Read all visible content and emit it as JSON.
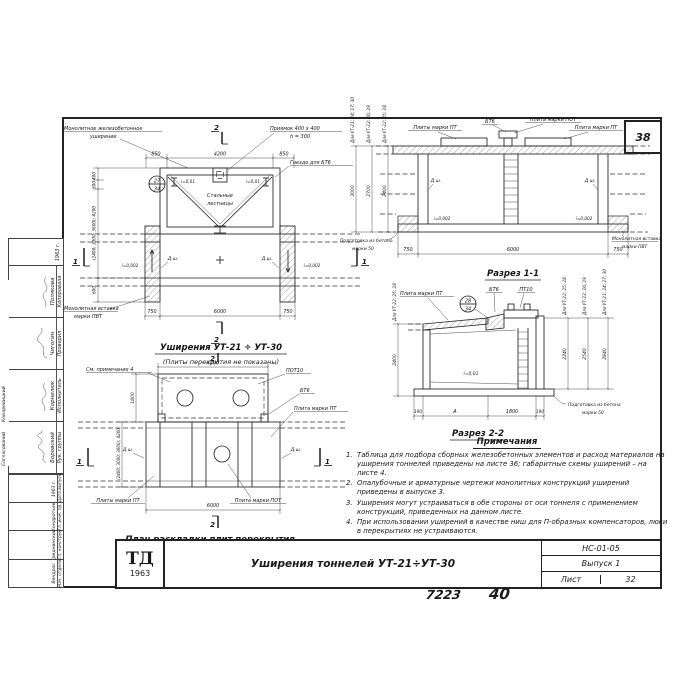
{
  "sheet": {
    "corner_number": "38",
    "footer_code": "7223",
    "footer_page": "40"
  },
  "titleblock": {
    "logo_top": "ТД",
    "logo_year": "1963",
    "title": "Уширения тоннелей УТ-21÷УТ-30",
    "doc_code": "НС-01-05",
    "issue": "Выпуск 1",
    "sheet_label": "Лист",
    "sheet_number": "32"
  },
  "stamp": {
    "side_role": "Согласований",
    "side_name": "Комаровицкий",
    "top_rows": [
      {
        "role": "Рук. группы",
        "name": "Боровский"
      },
      {
        "role": "Исполнитель",
        "name": "Корнилюк"
      },
      {
        "role": "Проверил",
        "name": "Чигогин"
      },
      {
        "role": "Копировала",
        "name": "Полякова"
      }
    ],
    "top_year": "1963 г.",
    "bottom_rows": [
      {
        "role": "Нач. отдела",
        "name": "Вендрос"
      },
      {
        "role": "Гл. конструктор",
        "name": "Гриднинский"
      },
      {
        "role": "Гл. инж. пр.",
        "name": "Кондратьев"
      },
      {
        "role": "Дата выпуска",
        "name": "1963 г."
      }
    ]
  },
  "notes": {
    "heading": "Примечания",
    "items": [
      {
        "n": "1.",
        "t": "Таблица для подбора сборных железобетонных элементов и расход материалов на уширения тоннелей приведены на листе 36; габаритные схемы уширений – на листе 4."
      },
      {
        "n": "2.",
        "t": "Опалубочные и арматурные чертежи монолитных конструкций уширений приведены в выпуске 3."
      },
      {
        "n": "3.",
        "t": "Уширения могут устраиваться в обе стороны от оси тоннеля с применением конструкций, приведенных на данном листе."
      },
      {
        "n": "4.",
        "t": "При использовании уширений в качестве ниш для П-образных компенсаторов, люки в перекрытиях не устраиваются."
      }
    ]
  },
  "plan": {
    "title": "Уширения УТ-21 ÷ УТ-30",
    "subtitle": "(Плиты перекрытия не показаны)",
    "label_monolith_1": "Монолитное железобетонное",
    "label_monolith_2": "уширение",
    "label_pit_1": "Приямок 400 x 400",
    "label_pit_2": "h = 300",
    "label_socket": "Гнездо для БТ6",
    "label_stairs_1": "Стальные",
    "label_stairs_2": "лестницы",
    "label_insert_1": "Монолитная вставка",
    "label_insert_2": "марки ПВТ",
    "label_dsh": "Д.ш.",
    "label_slope_top": "i=0,01",
    "label_slope": "i=0,002",
    "detail_top": "27",
    "detail_bottom": "34",
    "dim_850": "850",
    "dim_4200": "4200",
    "dim_750": "750",
    "dim_6000": "6000",
    "dim_400": "400",
    "dim_300": "300",
    "dim_var": "(2400; 3000; 3600); 4200",
    "dim_600": "600",
    "mark_1": "1",
    "mark_2": "2"
  },
  "section1": {
    "title": "Разрез 1-1",
    "label_bt6": "БТ6",
    "label_pot": "Плита марки ПОТ",
    "label_pt_pl": "Плиты марки ПТ",
    "label_pt": "Плита марки ПТ",
    "label_insert_1": "Монолитная вставка",
    "label_insert_2": "марки ПВТ",
    "label_prep_1": "Подготовка из бетона",
    "label_prep_2": "марки 50",
    "label_dsh": "Д.ш.",
    "label_slope": "i=0,002",
    "chains": [
      {
        "for": "Для УТ-21; 24; 27; 30",
        "value": "3000"
      },
      {
        "for": "Для УТ-23; 26; 29",
        "value": "2700"
      },
      {
        "for": "Для УТ-22; 25; 28",
        "value": "2400"
      }
    ],
    "dim_750": "750",
    "dim_6000": "6000"
  },
  "section2": {
    "title": "Разрез 2-2",
    "label_pt": "Плита марки ПТ",
    "label_bt6": "БТ6",
    "label_pt10": "ПТ10",
    "label_slope": "i=0,01",
    "label_prep_1": "Подготовка из бетона",
    "label_prep_2": "марки 50",
    "detail_top": "28",
    "detail_bottom": "34",
    "chain_left": {
      "for": "Для УТ-22; 25; 28",
      "value": "2400"
    },
    "chains_right": [
      {
        "for": "Для УТ-22; 25; 28",
        "value": "2240"
      },
      {
        "for": "Для УТ-23; 26; 29",
        "value": "2540"
      },
      {
        "for": "Для УТ-21; 24; 27; 30",
        "value": "2840"
      }
    ],
    "dim_190": "190",
    "dim_A": "А",
    "dim_1800": "1800"
  },
  "layout": {
    "title": "План раскладки плит перекрытия",
    "label_note4": "См. примечание 4",
    "label_pot10": "ПОТ10",
    "label_bt6": "БТ6",
    "label_pt": "Плита марки ПТ",
    "label_pt_pl": "Плиты марки ПТ",
    "label_pot": "Плита марки ПОТ",
    "label_dsh": "Д.ш.",
    "dim_4200": "4200",
    "dim_6000": "6000",
    "dim_1800": "1800",
    "dim_var": "(2400; 3000; 3600); 4200",
    "mark_1": "1",
    "mark_2": "2"
  }
}
